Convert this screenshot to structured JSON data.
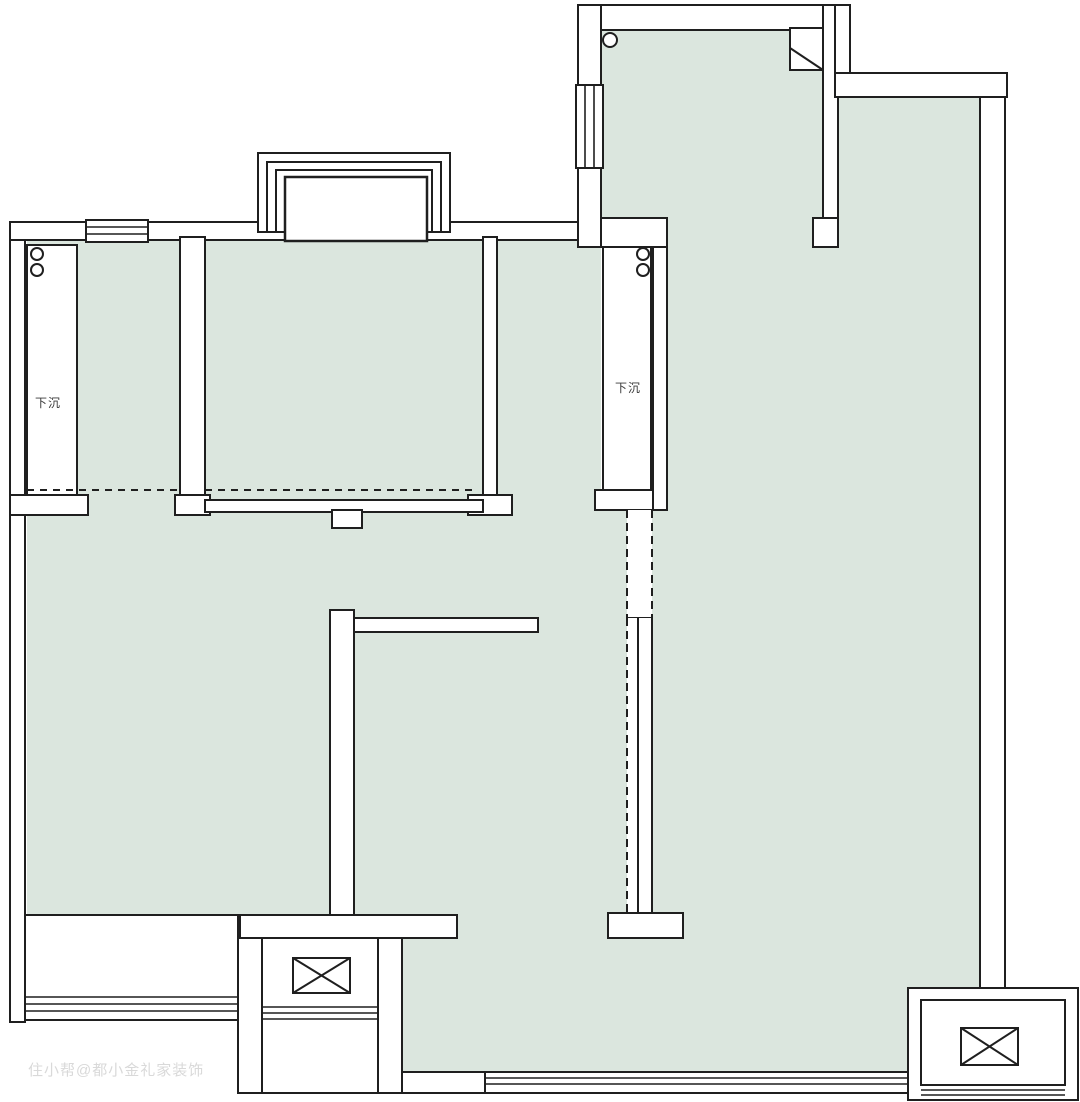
{
  "plan": {
    "title": "户型图",
    "sunken_areas": [
      {
        "label": "下沉"
      },
      {
        "label": "下沉"
      }
    ],
    "watermark": {
      "text": "住小帮@都小金礼家装饰"
    },
    "colors": {
      "room_fill": "#dbe6de",
      "wall_fill": "#ffffff",
      "line": "#1f1f1f",
      "label": "#3a3a3a",
      "watermark": "#d9d9d9",
      "background": "#ffffff"
    },
    "symbols": {
      "flue_shaft": "x-crossed-box",
      "drain_pipe": "small-circle",
      "window": "parallel-lines",
      "bay_window": "nested-rectangles",
      "opening_fold": "folded-corner",
      "sunken_boundary": "dashed-line",
      "removable_partition": "dashed-wall"
    }
  }
}
